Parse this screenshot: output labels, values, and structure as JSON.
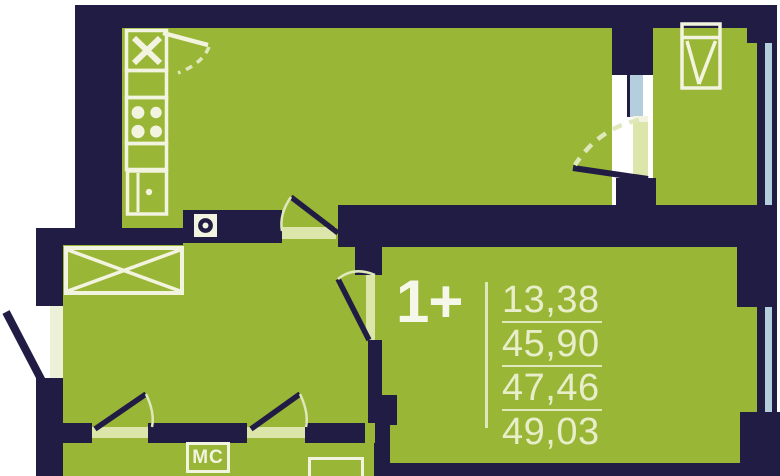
{
  "plan": {
    "unit_type_label": "1+",
    "area_values": [
      "13,38",
      "45,90",
      "47,46",
      "49,03"
    ],
    "washing_machine_label": "МС",
    "icons": [
      "sink-icon",
      "stove-icon",
      "fridge-icon",
      "counter-icon",
      "wardrobe-icon",
      "window-casement-icon",
      "washing-machine-icon",
      "riser-icon",
      "door-swing-icon"
    ]
  },
  "colors": {
    "wall": "#211c44",
    "room": "#9ab636",
    "glass": "#b5cede",
    "pale": "#dce6ab",
    "fixture": "#f2f4e0",
    "nums": "#e8eec9",
    "accent": "#f5f7ea",
    "line": "#dfe8bb",
    "bg": "#ffffff"
  }
}
